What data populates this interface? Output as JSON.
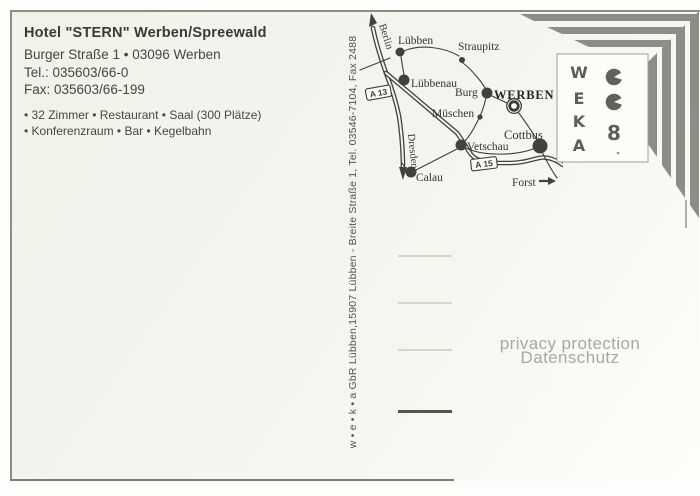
{
  "hotel": {
    "title": "Hotel \"STERN\" Werben/Spreewald",
    "address": "Burger Straße 1 • 03096 Werben",
    "tel": "Tel.: 035603/66-0",
    "fax": "Fax: 035603/66-199",
    "features": [
      "• 32 Zimmer • Restaurant • Saal (300 Plätze)",
      "• Konferenzraum • Bar • Kegelbahn"
    ]
  },
  "publisher": {
    "imprint": "w • e • k • a  GbR Lübben,15907 Lübben - Breite Straße 1, Tel. 03546-7104, Fax 2488"
  },
  "watermark": {
    "line1": "privacy protection",
    "line2": "Datenschutz"
  },
  "logo": {
    "letters": [
      "W",
      "E",
      "K",
      "A"
    ],
    "eight": "8"
  },
  "map": {
    "labels": {
      "berlin": "Berlin",
      "dresden": "Dresden",
      "forst": "Forst",
      "luebben": "Lübben",
      "straupitz": "Straupitz",
      "luebbenau": "Lübbenau",
      "burg": "Burg",
      "werben": "WERBEN",
      "mueschen": "Müschen",
      "vetschau": "Vetschau",
      "calau": "Calau",
      "cottbus": "Cottbus",
      "a13": "A 13",
      "a15": "A 15"
    }
  },
  "colors": {
    "stripe": "#8d8d85",
    "ink": "#3a3a34",
    "map_ink": "#3f3f38",
    "faint_line": "#d8d6c9",
    "dark_line": "#56554b",
    "watermark": "#a7a7a5"
  }
}
